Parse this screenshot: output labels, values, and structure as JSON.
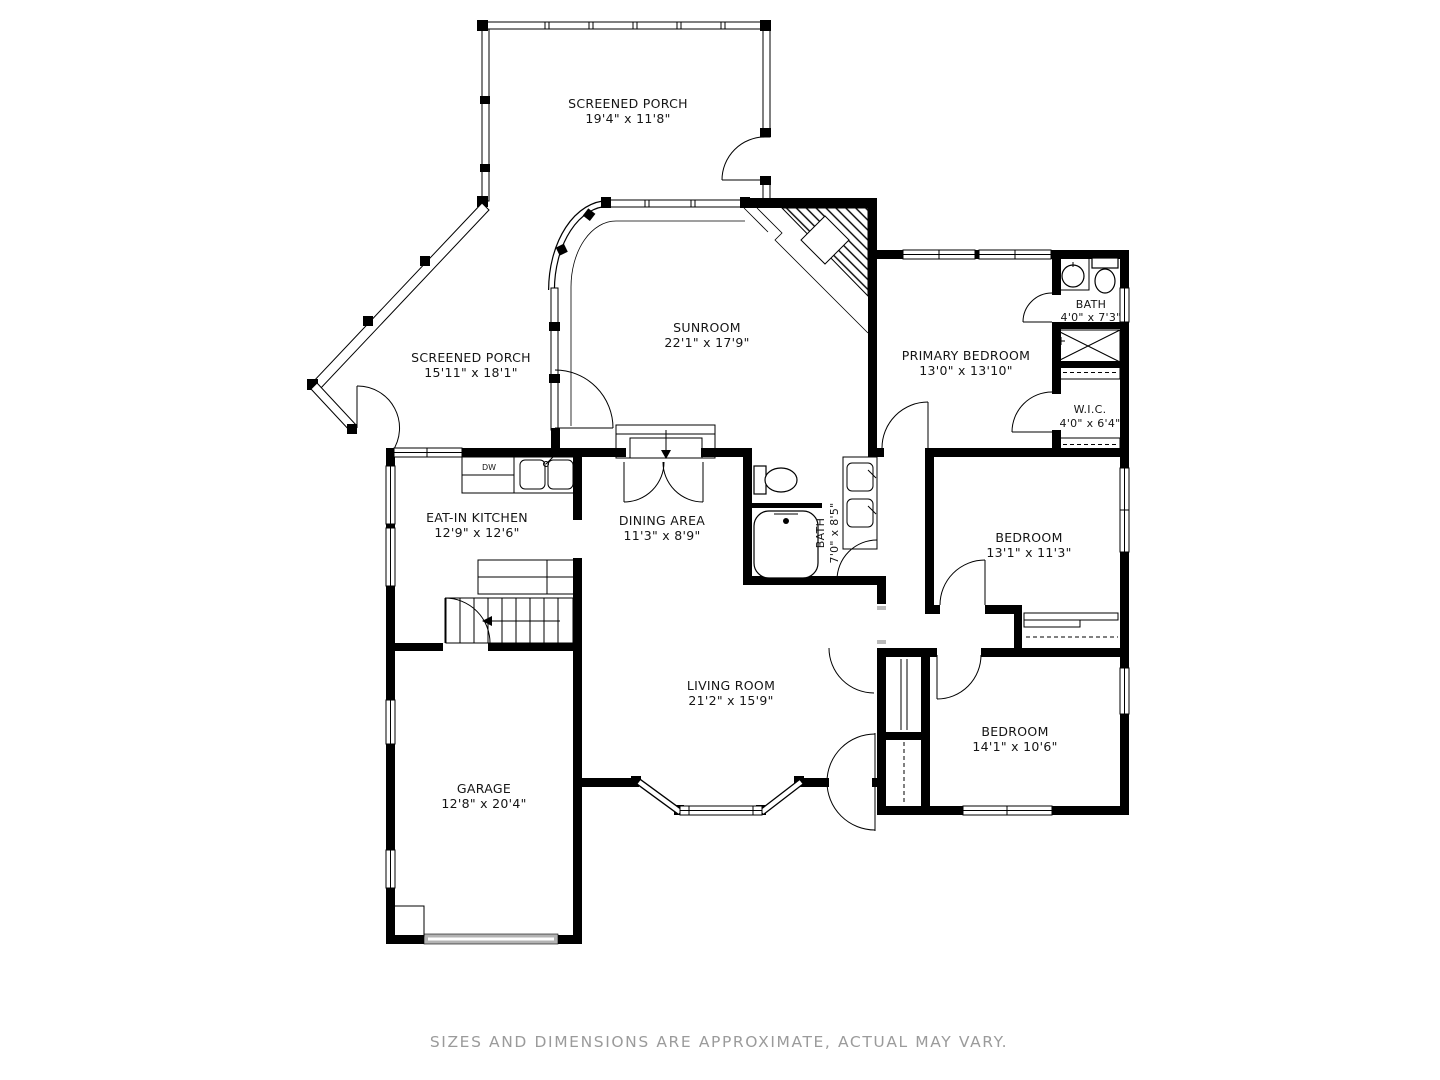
{
  "colors": {
    "wall": "#000000",
    "background": "#ffffff",
    "muted_text": "#9b9b9b",
    "garage_door": "#b3b3b3"
  },
  "rooms": {
    "screened_porch_top": {
      "name": "SCREENED PORCH",
      "dims": "19'4\" x 11'8\""
    },
    "screened_porch_left": {
      "name": "SCREENED PORCH",
      "dims": "15'11\" x 18'1\""
    },
    "sunroom": {
      "name": "SUNROOM",
      "dims": "22'1\" x 17'9\""
    },
    "primary_bedroom": {
      "name": "PRIMARY BEDROOM",
      "dims": "13'0\" x 13'10\""
    },
    "primary_bath": {
      "name": "BATH",
      "dims": "4'0\" x 7'3\""
    },
    "wic": {
      "name": "W.I.C.",
      "dims": "4'0\" x 6'4\""
    },
    "eat_in_kitchen": {
      "name": "EAT-IN KITCHEN",
      "dims": "12'9\" x 12'6\""
    },
    "dining_area": {
      "name": "DINING AREA",
      "dims": "11'3\" x 8'9\""
    },
    "main_bath": {
      "name": "BATH",
      "dims": "7'0\" x 8'5\""
    },
    "bedroom_upper": {
      "name": "BEDROOM",
      "dims": "13'1\" x 11'3\""
    },
    "bedroom_lower": {
      "name": "BEDROOM",
      "dims": "14'1\" x 10'6\""
    },
    "living_room": {
      "name": "LIVING ROOM",
      "dims": "21'2\" x 15'9\""
    },
    "garage": {
      "name": "GARAGE",
      "dims": "12'8\" x 20'4\""
    }
  },
  "labels": {
    "dishwasher": "DW"
  },
  "footer": {
    "disclaimer": "SIZES AND DIMENSIONS ARE APPROXIMATE, ACTUAL MAY VARY."
  }
}
